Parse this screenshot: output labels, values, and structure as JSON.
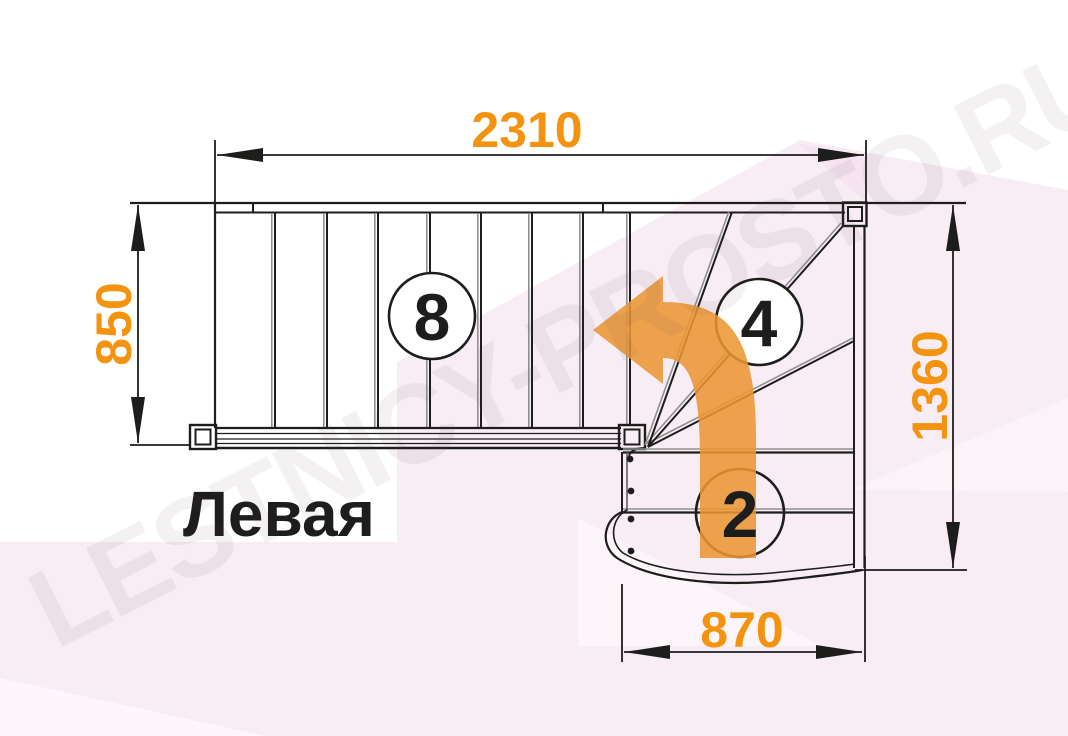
{
  "diagram": {
    "title_label": "Левая",
    "watermark": "LESTNICY-PROSTO.RU",
    "dimensions": {
      "top_width": "2310",
      "left_height": "850",
      "right_height": "1360",
      "bottom_width": "870"
    },
    "step_counts": {
      "upper_flight": "8",
      "winder": "4",
      "lower_flight": "2"
    },
    "colors": {
      "dimension_text": "#F3930F",
      "arrow": "#EB9532",
      "line": "#1D1D1B",
      "background_pink": "#F8EDF5"
    }
  }
}
